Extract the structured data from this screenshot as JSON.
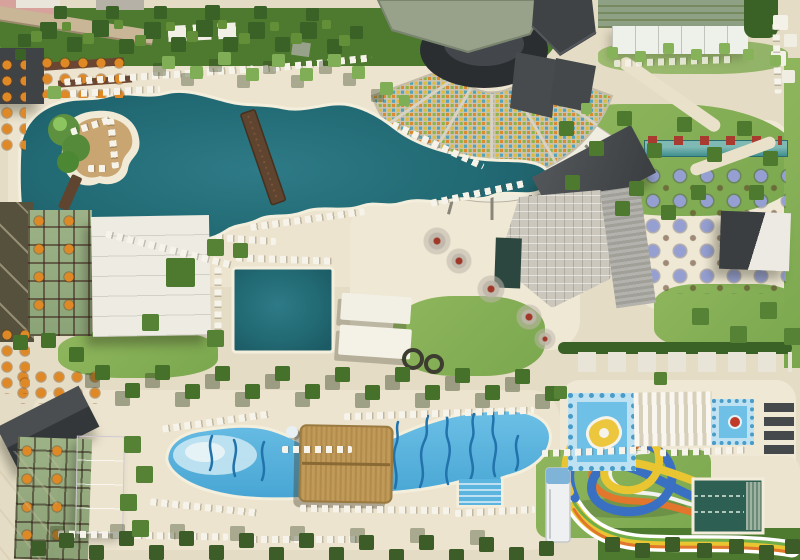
{
  "meta": {
    "title": "Aerial view of resort pool complex",
    "kind": "aerial-photograph",
    "width": 800,
    "height": 560
  },
  "colors": {
    "sand": "#e5dcc5",
    "deck": "#ece4ce",
    "deck_light": "#efe8d4",
    "pool_teal": "#226b75",
    "pool_teal_dark": "#1c5a64",
    "pool_rim": "#f4efdd",
    "wave_blue": "#5cb5de",
    "wave_dark": "#2273ab",
    "wave_pale": "#c6e6f2",
    "kids_blue": "#6ec0e6",
    "lap_green": "#2e5f53",
    "grass": "#7aa74e",
    "grass_light": "#8fb65d",
    "tree_green": "#4d7a2e",
    "tree_dark": "#3a6126",
    "tree_palm": "#7fae57",
    "roof_charcoal": "#3f4346",
    "roof_gray": "#cbc7bd",
    "roof_sage": "#98a28a",
    "dome": "#2b2e31",
    "wood": "#5f4430",
    "thatch": "#c09a58",
    "maroon": "#7b453a",
    "balcony_green": "#9db387",
    "orange": "#df8926",
    "lavender": "#959fd2",
    "red_seat": "#a83a30",
    "white": "#f6f3ea",
    "court_pink": "#e8b7cc",
    "court_pink_pale": "#ded6e3",
    "slide_blue": "#3a70c2",
    "slide_yellow": "#e9c531",
    "slide_orange": "#e1762c",
    "slide_green": "#6fae4b",
    "seat_yellow": "#dfb93c",
    "seat_green": "#8db44a",
    "seat_blue": "#54a3b8",
    "seat_orange": "#d98a33",
    "teal_building": "#2c473f"
  },
  "scene": {
    "areas": [
      {
        "name": "main-pool",
        "label": "Large freeform lagoon pool"
      },
      {
        "name": "pool-island",
        "label": "Island with palms and sun loungers"
      },
      {
        "name": "island-bridge",
        "label": "Wooden footbridge to island"
      },
      {
        "name": "pool-bridge",
        "label": "Wooden bridge across pool"
      },
      {
        "name": "amphitheater",
        "label": "Open-air amphitheater with colored seats"
      },
      {
        "name": "amphitheater-stage",
        "label": "Stage with dark dome and green roof"
      },
      {
        "name": "cabana-arc",
        "label": "Arc of white cabana platforms"
      },
      {
        "name": "relax-pool",
        "label": "Rectangular quiet pool"
      },
      {
        "name": "shade-canopies",
        "label": "White shade canopies"
      },
      {
        "name": "plaza",
        "label": "Plaza with ornamental blossom trees"
      },
      {
        "name": "restaurant-roof",
        "label": "Large gray tiled restaurant roof"
      },
      {
        "name": "terrace-umbrellas",
        "label": "Dining terrace with lavender umbrellas"
      },
      {
        "name": "swim-up-bar",
        "label": "Narrow bar pool with red loungers"
      },
      {
        "name": "wave-pool",
        "label": "Wave pool with painted wave lines"
      },
      {
        "name": "tiki-hut",
        "label": "Thatched tiki bar roof"
      },
      {
        "name": "kids-pool-large",
        "label": "Kids mosaic pool with character motif"
      },
      {
        "name": "kids-pool-small",
        "label": "Small kids mosaic pool"
      },
      {
        "name": "slat-canopy",
        "label": "White slatted sunshade"
      },
      {
        "name": "waterslides",
        "label": "Looping multicolor waterslides"
      },
      {
        "name": "slide-tower",
        "label": "Waterslide start tower"
      },
      {
        "name": "plunge-pool",
        "label": "Slide landing lap pool"
      },
      {
        "name": "guest-buildings",
        "label": "Guest room buildings with balconies"
      },
      {
        "name": "pink-court",
        "label": "Pink sports court"
      },
      {
        "name": "sports-courts",
        "label": "Courts with green pergola roof"
      },
      {
        "name": "gardens",
        "label": "Lawns, palms and tree alleys"
      }
    ]
  }
}
